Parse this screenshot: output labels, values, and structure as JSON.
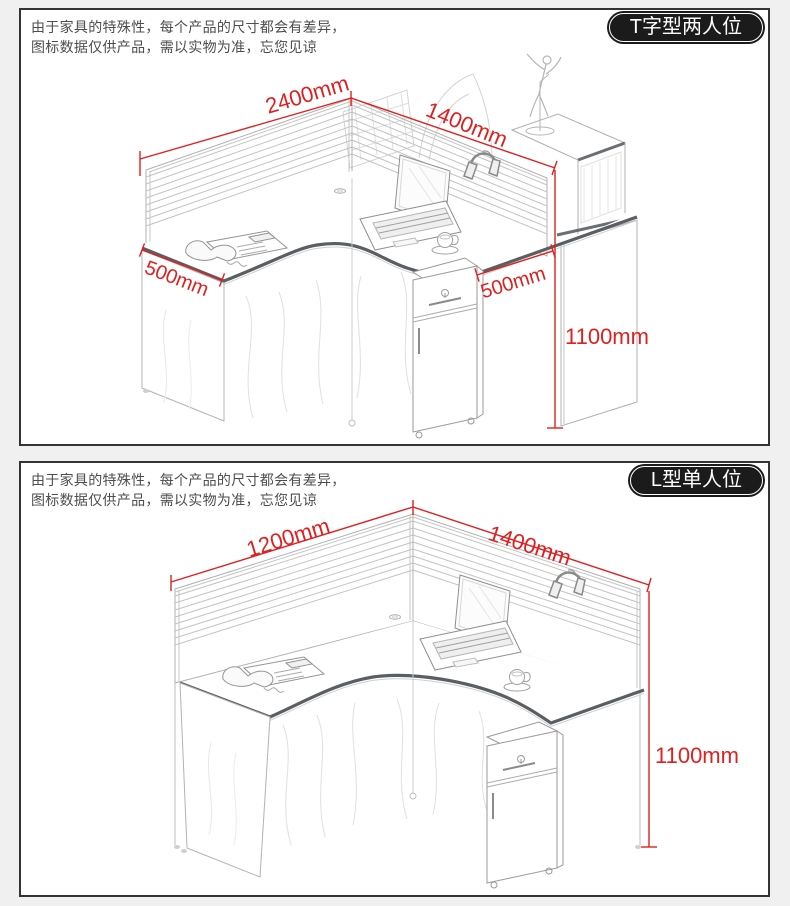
{
  "colors": {
    "background": "#f0f0f0",
    "panel_bg": "#ffffff",
    "panel_border": "#333333",
    "badge_bg": "#1b1b1b",
    "badge_text": "#ffffff",
    "dimension_red": "#e02020",
    "drawing_line_gray": "#b0b0b0",
    "desk_trim_gray": "#5a5f63"
  },
  "panels": [
    {
      "badge": "T字型两人位",
      "disclaimer": {
        "line1": "由于家具的特殊性，每个产品的尺寸都会有差异，",
        "line2": "图标数据仅供产品，需以实物为准，忘您见谅"
      },
      "dimensions": {
        "main_width": "2400mm",
        "return_width": "1400mm",
        "left_depth": "500mm",
        "right_depth": "500mm",
        "height": "1100mm"
      }
    },
    {
      "badge": "L型单人位",
      "disclaimer": {
        "line1": "由于家具的特殊性，每个产品的尺寸都会有差异，",
        "line2": "图标数据仅供产品，需以实物为准，忘您见谅"
      },
      "dimensions": {
        "main_width": "1200mm",
        "return_width": "1400mm",
        "height": "1100mm"
      }
    }
  ]
}
